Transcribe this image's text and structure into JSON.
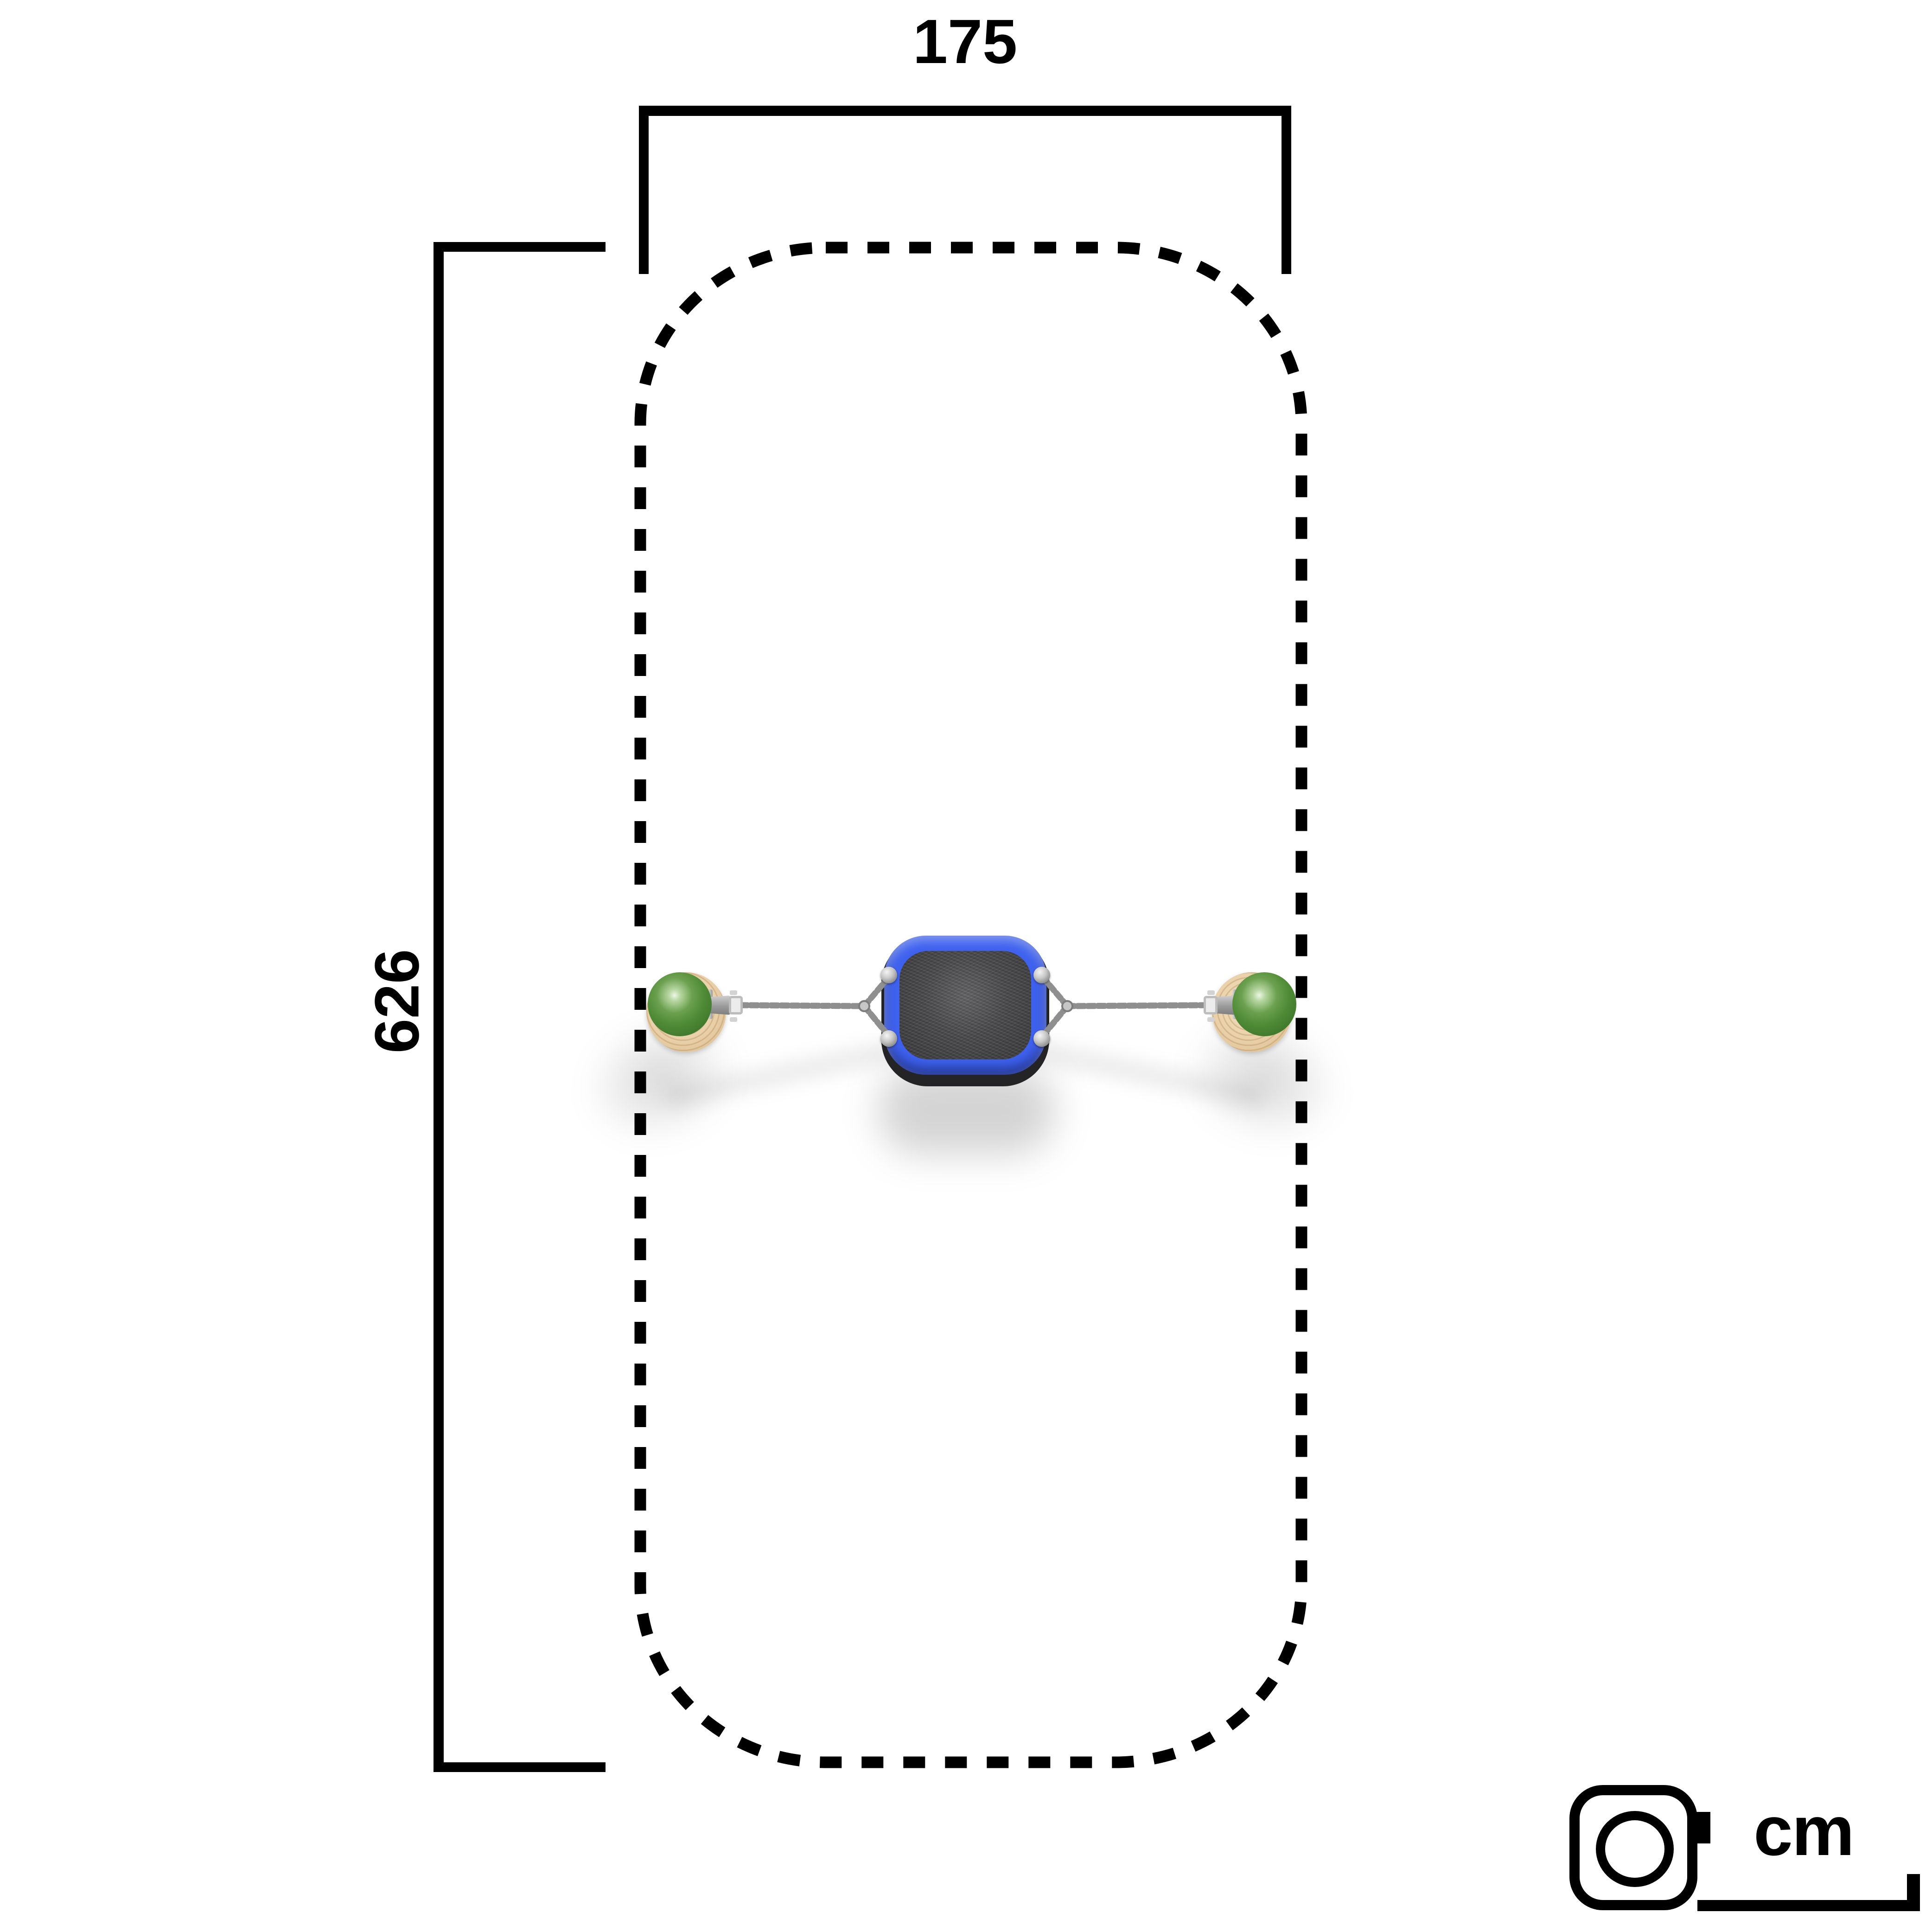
{
  "dimensions": {
    "width_cm": "175",
    "height_cm": "626",
    "unit": "cm"
  },
  "legend": {
    "unit_label": "cm",
    "icon": "tape-measure-icon"
  },
  "scene": {
    "view": "top-view-plan",
    "safety_zone_outline": "dashed-rounded-rectangle",
    "equipment": "single-swing-seat-with-chains-between-two-ball-capped-wooden-posts"
  },
  "colors": {
    "frame_blue": "#3e61ee",
    "ball_green": "#4e8a36",
    "wood": "#e9d0a9",
    "seat_gray": "#4a4a4c",
    "line_black": "#000000",
    "background": "#ffffff"
  }
}
